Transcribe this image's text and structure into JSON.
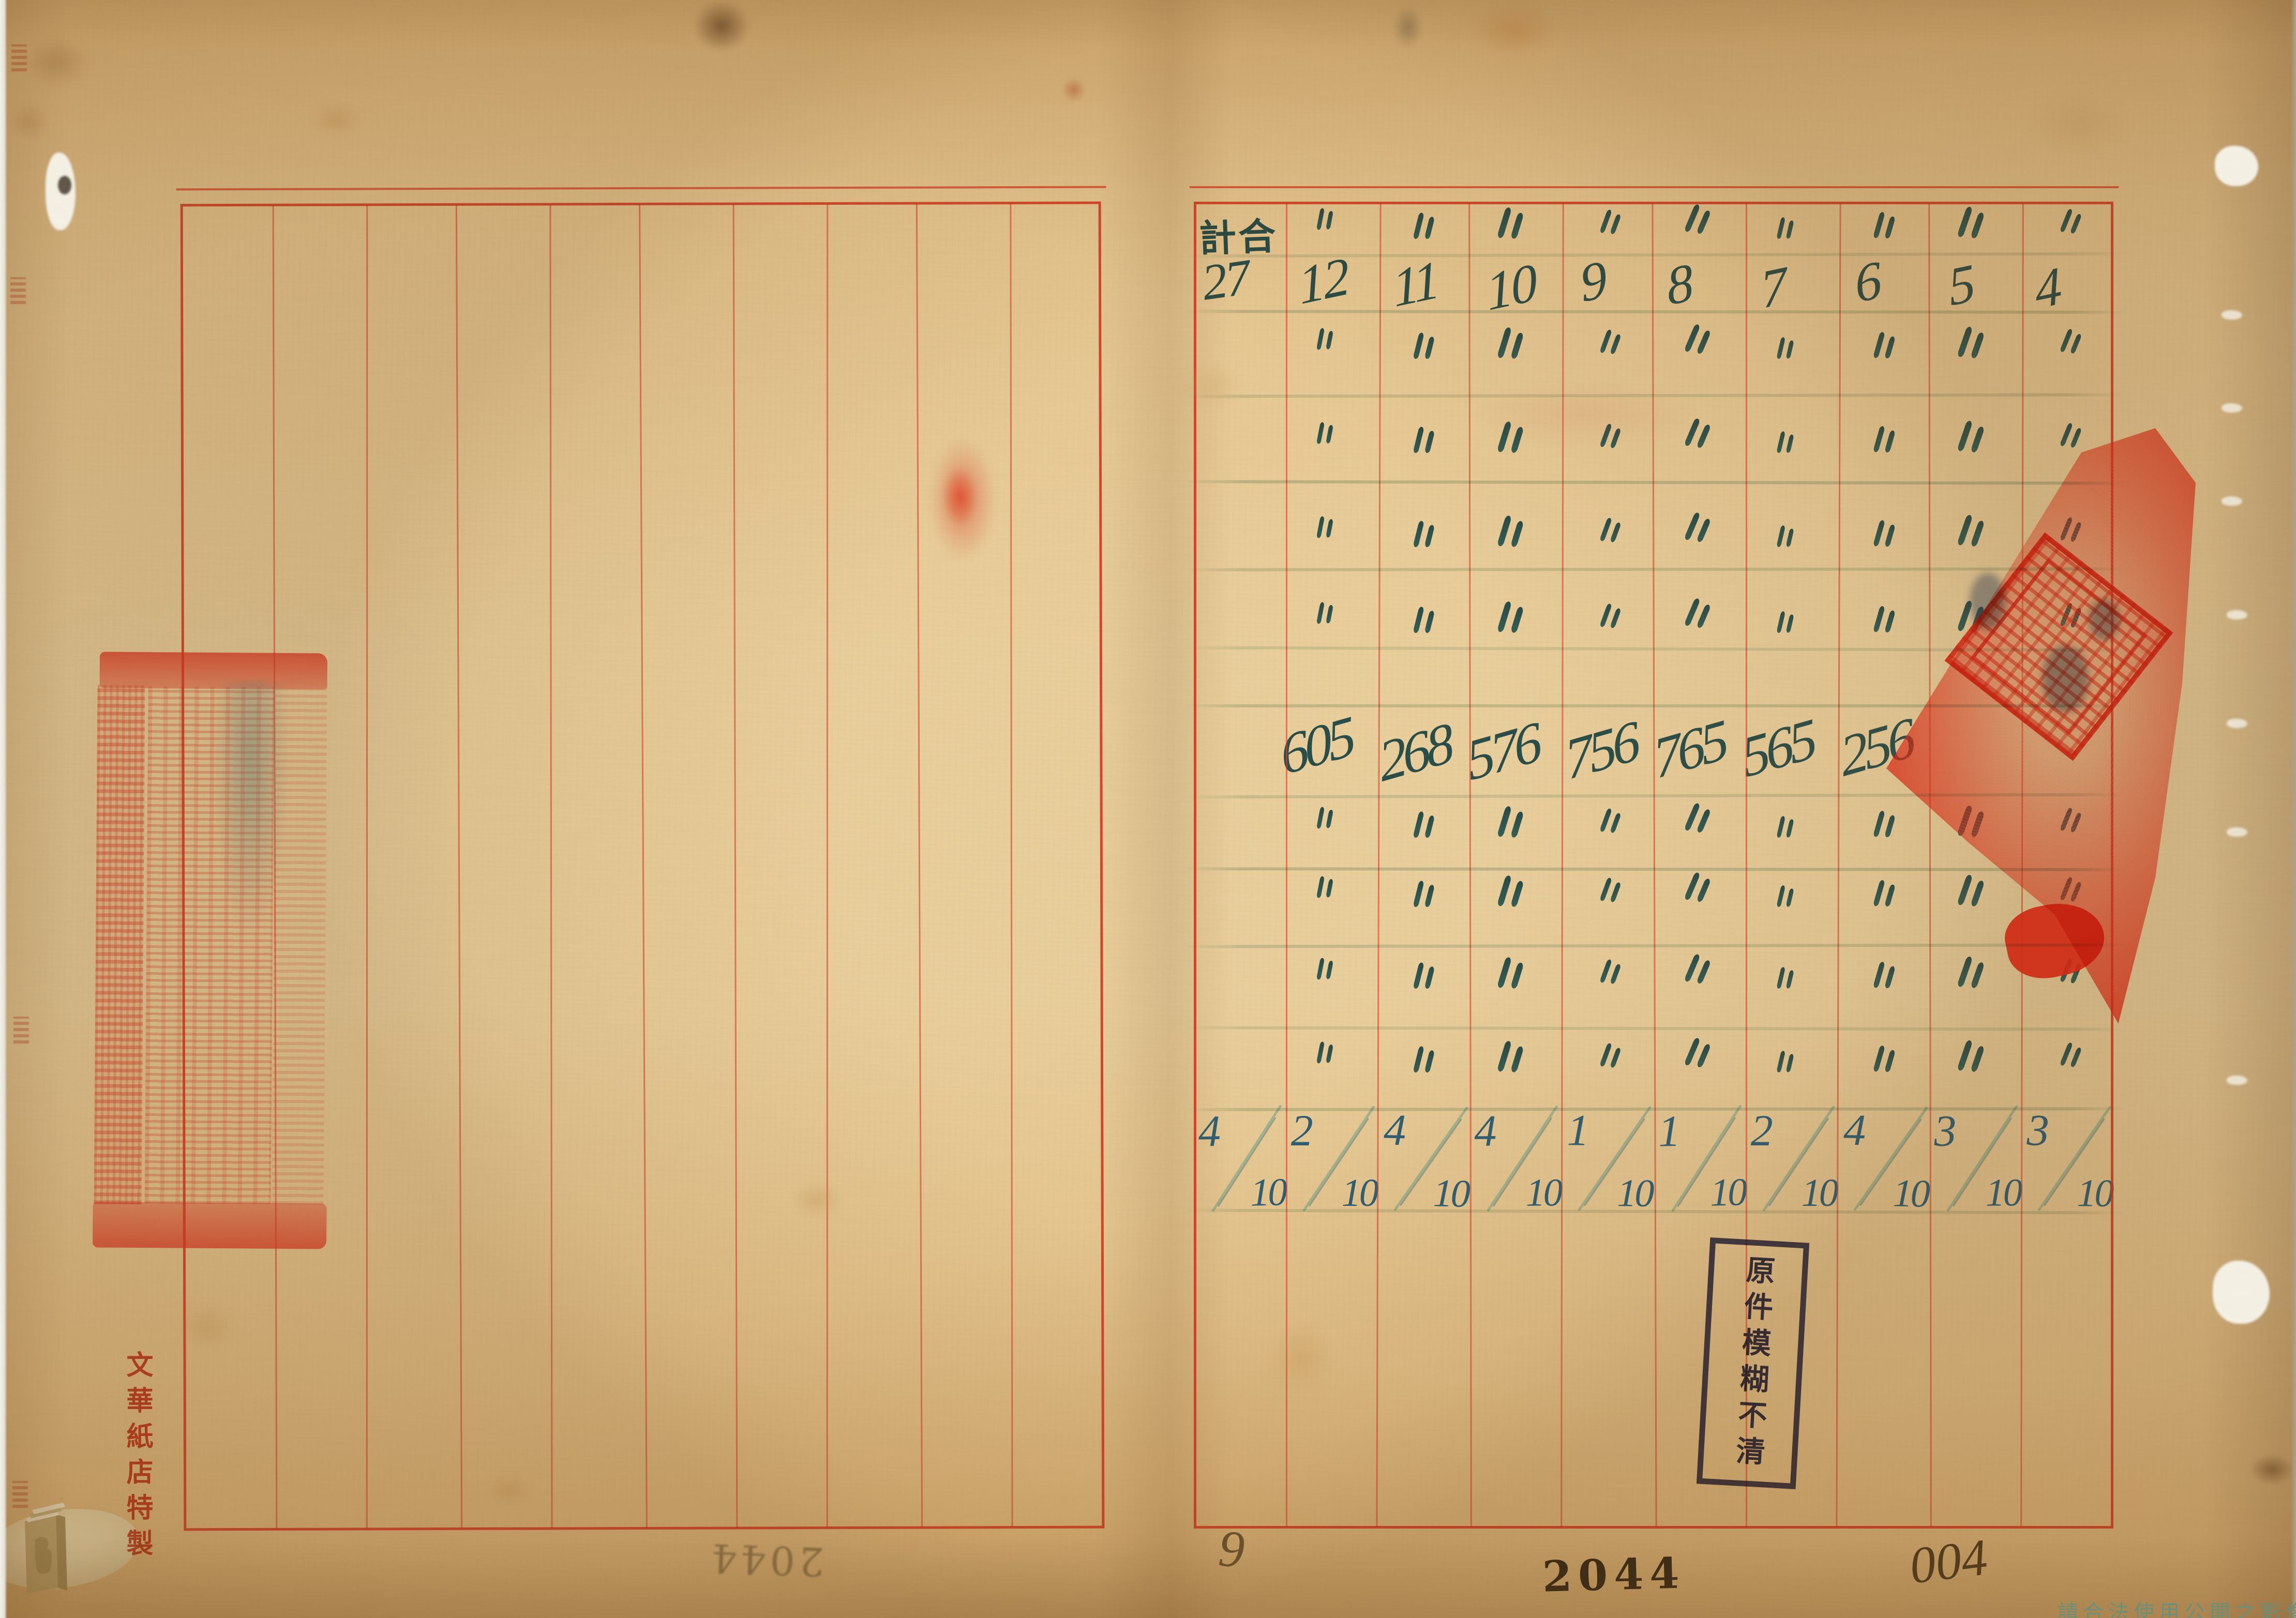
{
  "document_kind": "scanned ledger spread",
  "right_sheet": {
    "header_label": "計合",
    "header_total_value": "27",
    "column_values": [
      "12",
      "11",
      "10",
      "9",
      "8",
      "7",
      "6",
      "5",
      "4"
    ],
    "ditto_symbol": "〃",
    "ditto_rows": {
      "top_count": 9,
      "upper_counts": [
        9,
        9,
        9,
        9
      ],
      "lower_counts": [
        9,
        9,
        9,
        9
      ]
    },
    "mid_row_values": [
      "605",
      "268",
      "576",
      "756",
      "765",
      "565",
      "256"
    ],
    "fractions": [
      {
        "num": "4",
        "den": "10"
      },
      {
        "num": "2",
        "den": "10"
      },
      {
        "num": "4",
        "den": "10"
      },
      {
        "num": "4",
        "den": "10"
      },
      {
        "num": "1",
        "den": "10"
      },
      {
        "num": "1",
        "den": "10"
      },
      {
        "num": "2",
        "den": "10"
      },
      {
        "num": "4",
        "den": "10"
      },
      {
        "num": "3",
        "den": "10"
      },
      {
        "num": "3",
        "den": "10"
      }
    ]
  },
  "left_sheet": {
    "maker_text": "文華紙店特製",
    "mirror_page_number": "2044"
  },
  "stamps": {
    "blur_notice_text": "原件模糊不清"
  },
  "footer": {
    "printed_number": "2044",
    "pencil_number": "004",
    "pencil_digit": "9",
    "watermark_text": "請合法使用公開之影像"
  },
  "colors": {
    "paper": "#ecd2a0",
    "grid_red": "#db4230",
    "border_red": "#d4341e",
    "ink_blue": "#2c5f78",
    "rule_green": "#7ca492",
    "seal_red": "#e8301c",
    "stamp_navy": "#2a2e68",
    "pencil_grey": "#55503f",
    "print_black": "#35312a",
    "watermark_green": "#6892a0"
  }
}
